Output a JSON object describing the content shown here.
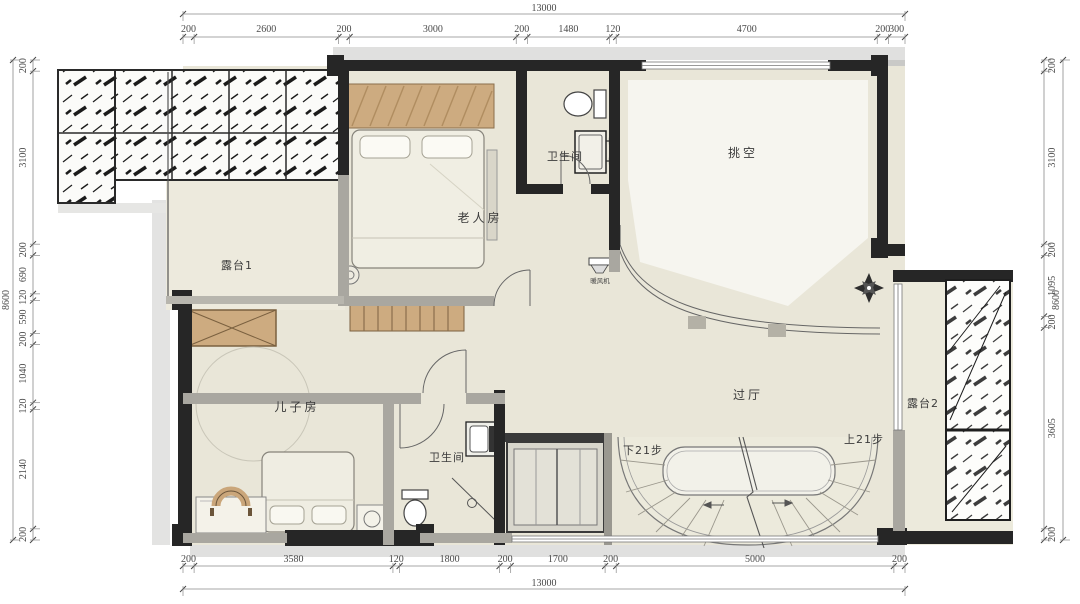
{
  "rooms": {
    "terrace1": "露台1",
    "elder_room": "老人房",
    "bath_top": "卫生间",
    "void_space": "挑空",
    "hall": "过厅",
    "son_room": "儿子房",
    "bath_bottom": "卫生间",
    "terrace2": "露台2",
    "stairs_down": "下21步",
    "stairs_up": "上21步",
    "equipment": "暖风机"
  },
  "dimensions": {
    "top": {
      "total": "13000",
      "segments": [
        "200",
        "2600",
        "200",
        "3000",
        "200",
        "1480",
        "120",
        "4700",
        "200",
        "300"
      ]
    },
    "bottom": {
      "total": "13000",
      "segments": [
        "200",
        "3580",
        "120",
        "1800",
        "200",
        "1700",
        "200",
        "5000",
        "200"
      ]
    },
    "left": {
      "total": "8600",
      "segments": [
        "200",
        "3100",
        "200",
        "690",
        "120",
        "590",
        "200",
        "1040",
        "120",
        "2140",
        "200"
      ]
    },
    "right": {
      "total": "8600",
      "segments": [
        "200",
        "3100",
        "200",
        "1095",
        "200",
        "3605",
        "200"
      ]
    }
  },
  "colors": {
    "floor": "#e9e6d8",
    "terrace_floor": "#eceadc",
    "wall_dark": "#262626",
    "wall_gray": "#a9a7a0",
    "wood": "#cdab80",
    "void_light": "#f6f5ef",
    "dim_text": "#4a4a4a"
  }
}
